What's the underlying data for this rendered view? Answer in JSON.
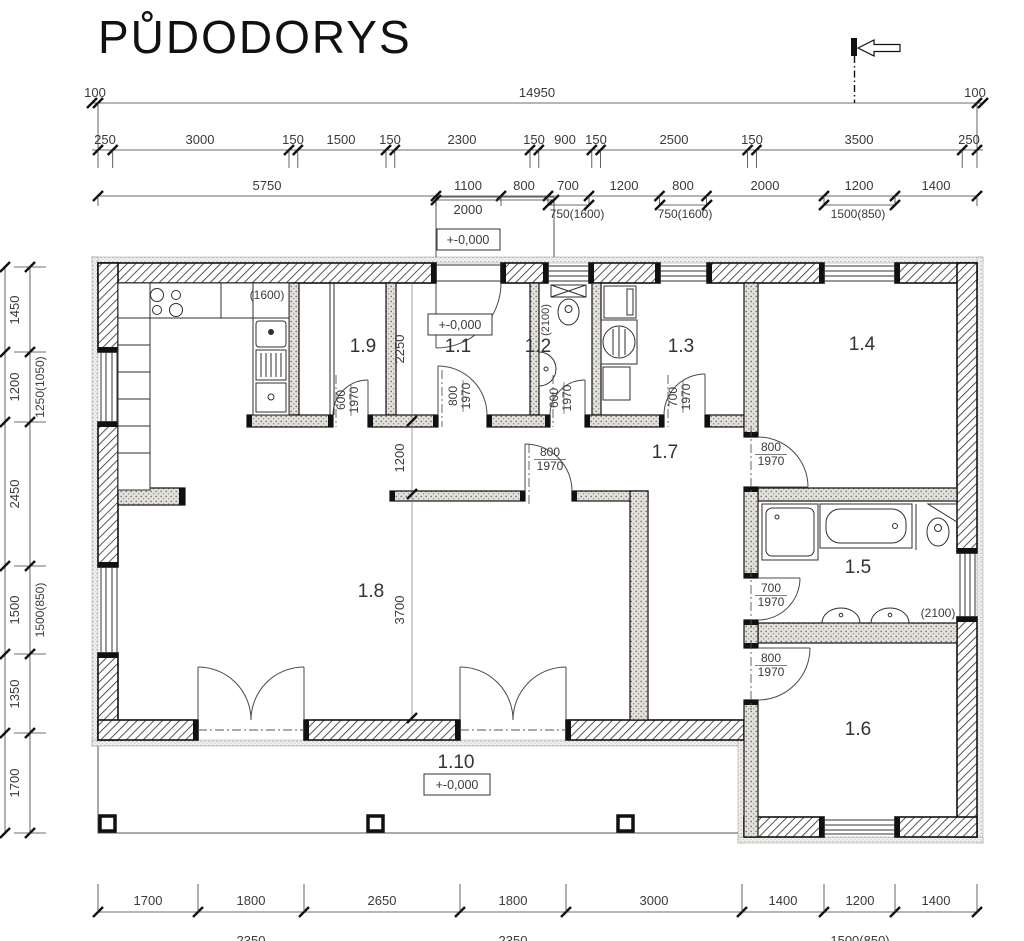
{
  "title": "PŮDODORYS",
  "dims": {
    "top1": [
      "100",
      "14950",
      "100"
    ],
    "top2": [
      "250",
      "3000",
      "150",
      "1500",
      "150",
      "2300",
      "150",
      "900",
      "150",
      "2500",
      "150",
      "3500",
      "250"
    ],
    "top3": [
      "5750",
      "1100",
      "800",
      "700",
      "1200",
      "800",
      "2000",
      "1200",
      "1400"
    ],
    "top4": [
      "2000",
      "750(1600)",
      "750(1600)",
      "1500(850)"
    ],
    "left": [
      "1450",
      "1200",
      "2450",
      "1500",
      "1350",
      "1700"
    ],
    "left_paren": [
      "1250(1050)",
      "1500(850)"
    ],
    "bottom1": [
      "1700",
      "1800",
      "2650",
      "1800",
      "3000",
      "1400",
      "1200",
      "1400"
    ],
    "bottom2": [
      "2350",
      "2350",
      "1500(850)"
    ],
    "interior": [
      "2250",
      "1200",
      "3700"
    ]
  },
  "rooms": [
    "1.1",
    "1.2",
    "1.3",
    "1.4",
    "1.5",
    "1.6",
    "1.7",
    "1.8",
    "1.9",
    "1.10"
  ],
  "door_labels": {
    "d19": [
      "600",
      "1970"
    ],
    "d11": [
      "800",
      "1970"
    ],
    "d12": [
      "600",
      "1970"
    ],
    "d13": [
      "700",
      "1970"
    ],
    "d18": [
      "800",
      "1970"
    ],
    "d14": [
      "800",
      "1970"
    ],
    "d15": [
      "700",
      "1970"
    ],
    "d16": [
      "800",
      "1970"
    ]
  },
  "annotations": {
    "kitchen_counter": "(1600)",
    "wc_ceiling": "(2100)",
    "bath_ceiling": "(2100)",
    "level_zero": "+-0,000"
  }
}
